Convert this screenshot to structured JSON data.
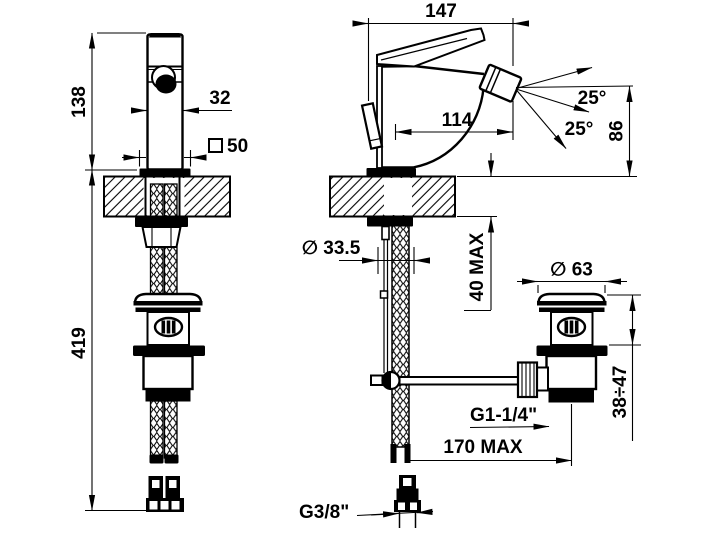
{
  "drawing": {
    "kind": "installation dimension drawing, single-lever bidet mixer with pop-up waste and flexible supply hoses",
    "colors": {
      "line": "#000000",
      "background": "#ffffff"
    }
  },
  "labels": {
    "front": {
      "spout_height": "138",
      "hose_length": "419",
      "body_width": "32",
      "base_square_value": "50"
    },
    "side": {
      "depth_total": "147",
      "spout_reach": "114",
      "angle_upper": "25°",
      "angle_lower": "25°",
      "outlet_height": "86",
      "hole_diameter": "∅ 33.5",
      "deck_max": "40 MAX",
      "waste_cap_diameter": "∅ 63",
      "waste_height_range": "38÷47",
      "waste_thread": "G1-1/4\"",
      "horizontal_max": "170 MAX",
      "supply_thread": "G3/8\""
    }
  }
}
